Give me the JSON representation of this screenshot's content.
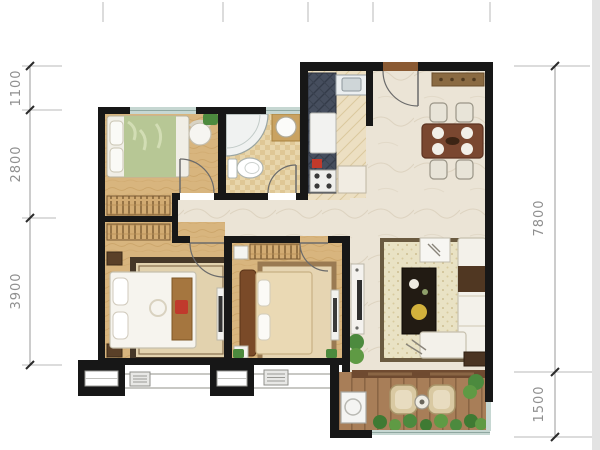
{
  "title": "apartment-floor-plan",
  "plan": {
    "dimensions_left": [
      {
        "value": "1100"
      },
      {
        "value": "2800"
      },
      {
        "value": "3900"
      }
    ],
    "dimensions_right": [
      {
        "value": "7800"
      },
      {
        "value": "1500"
      }
    ],
    "rooms": [
      "bedroom",
      "bathroom",
      "kitchen",
      "entry",
      "dining-area",
      "master-bedroom",
      "second-bedroom",
      "living-room",
      "balcony"
    ],
    "colors": {
      "wall": "#171717",
      "wood_floor": "#d8b57e",
      "marble_floor": "#ebe4d6",
      "bathroom_tile": "#e8d6ac",
      "kitchen_counter": "#464e5e",
      "deck": "#a87e58",
      "plant_green": "#4c8a3e",
      "window_glass": "#c6d7d2",
      "dimension_text": "#8f8f8f"
    }
  }
}
